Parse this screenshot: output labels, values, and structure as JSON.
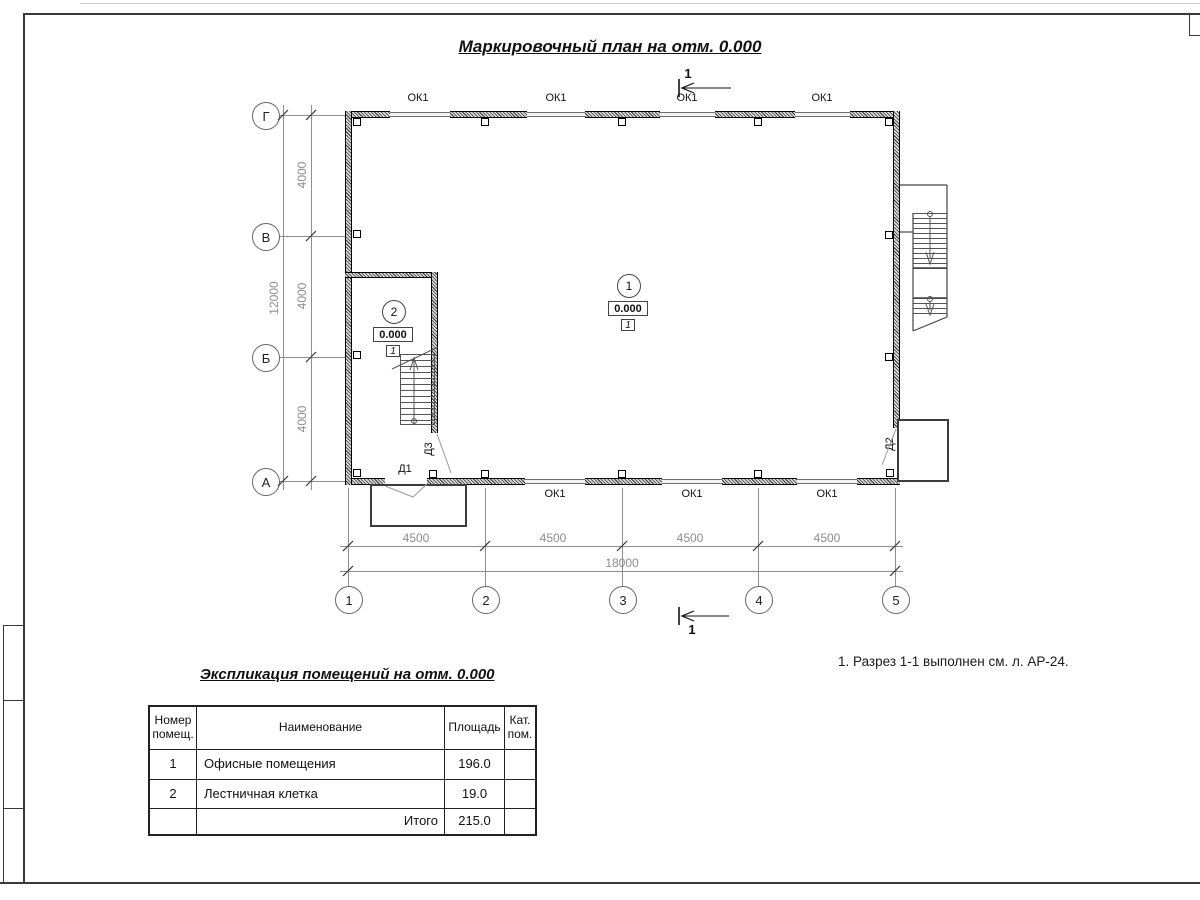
{
  "sheet": {
    "title": "Маркировочный план на отм. 0.000",
    "note": "1. Разрез 1-1 выполнен см. л. АР-24.",
    "section_label": "1"
  },
  "axes": {
    "rows": [
      "Г",
      "В",
      "Б",
      "А"
    ],
    "cols": [
      "1",
      "2",
      "3",
      "4",
      "5"
    ]
  },
  "dimensions": {
    "vertical": {
      "segments": [
        "4000",
        "4000",
        "4000"
      ],
      "total": "12000"
    },
    "horizontal": {
      "segments": [
        "4500",
        "4500",
        "4500",
        "4500"
      ],
      "total": "18000"
    }
  },
  "openings": {
    "windows_top": [
      "ОК1",
      "ОК1",
      "ОК1",
      "ОК1"
    ],
    "windows_bottom": [
      "ОК1",
      "ОК1",
      "ОК1"
    ],
    "door1": "Д1",
    "door2": "Д2",
    "door3": "Д3"
  },
  "rooms": [
    {
      "number": "1",
      "elevation": "0.000",
      "floor_type": "1"
    },
    {
      "number": "2",
      "elevation": "0.000",
      "floor_type": "1"
    }
  ],
  "schedule": {
    "title": "Экспликация помещений на отм. 0.000",
    "headers": [
      "Номер помещ.",
      "Наименование",
      "Площадь",
      "Кат. пом."
    ],
    "rows": [
      {
        "number": "1",
        "name": "Офисные помещения",
        "area": "196.0",
        "category": ""
      },
      {
        "number": "2",
        "name": "Лестничная клетка",
        "area": "19.0",
        "category": ""
      }
    ],
    "total_label": "Итого",
    "total_area": "215.0"
  }
}
